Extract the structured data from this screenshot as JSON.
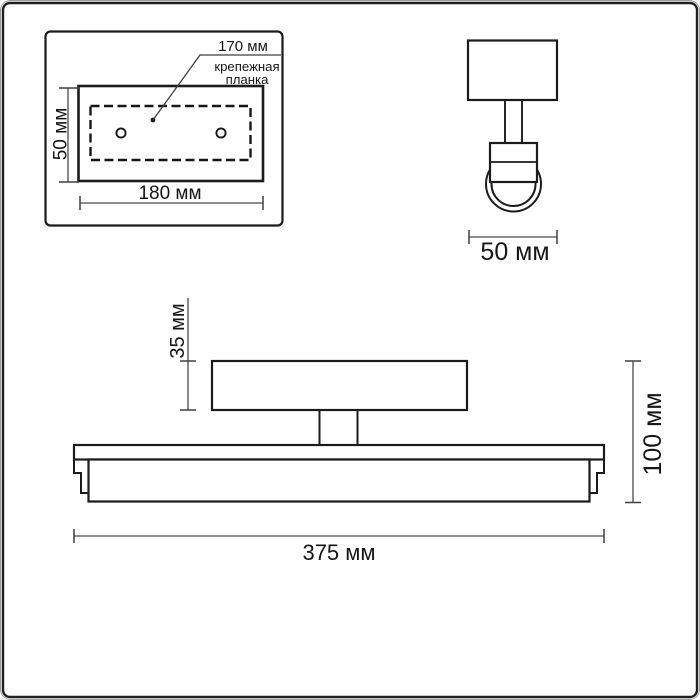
{
  "drawing": {
    "kind": "luminaire-dimension-drawing",
    "units": "мм",
    "colors": {
      "background": "#ffffff",
      "object_line": "#1b1b1b",
      "dimension_line": "#4a4a4a",
      "text": "#161616",
      "frame": "#1f1f1f"
    },
    "top_view": {
      "holes_spacing_label": "170 мм",
      "caption_line1": "крепежная",
      "caption_line2": "планка",
      "height_label": "50 мм",
      "width_label": "180 мм"
    },
    "side_view": {
      "width_label": "50 мм"
    },
    "front_view": {
      "plate_height_label": "35 мм",
      "total_height_label": "100 мм",
      "total_width_label": "375 мм"
    }
  }
}
